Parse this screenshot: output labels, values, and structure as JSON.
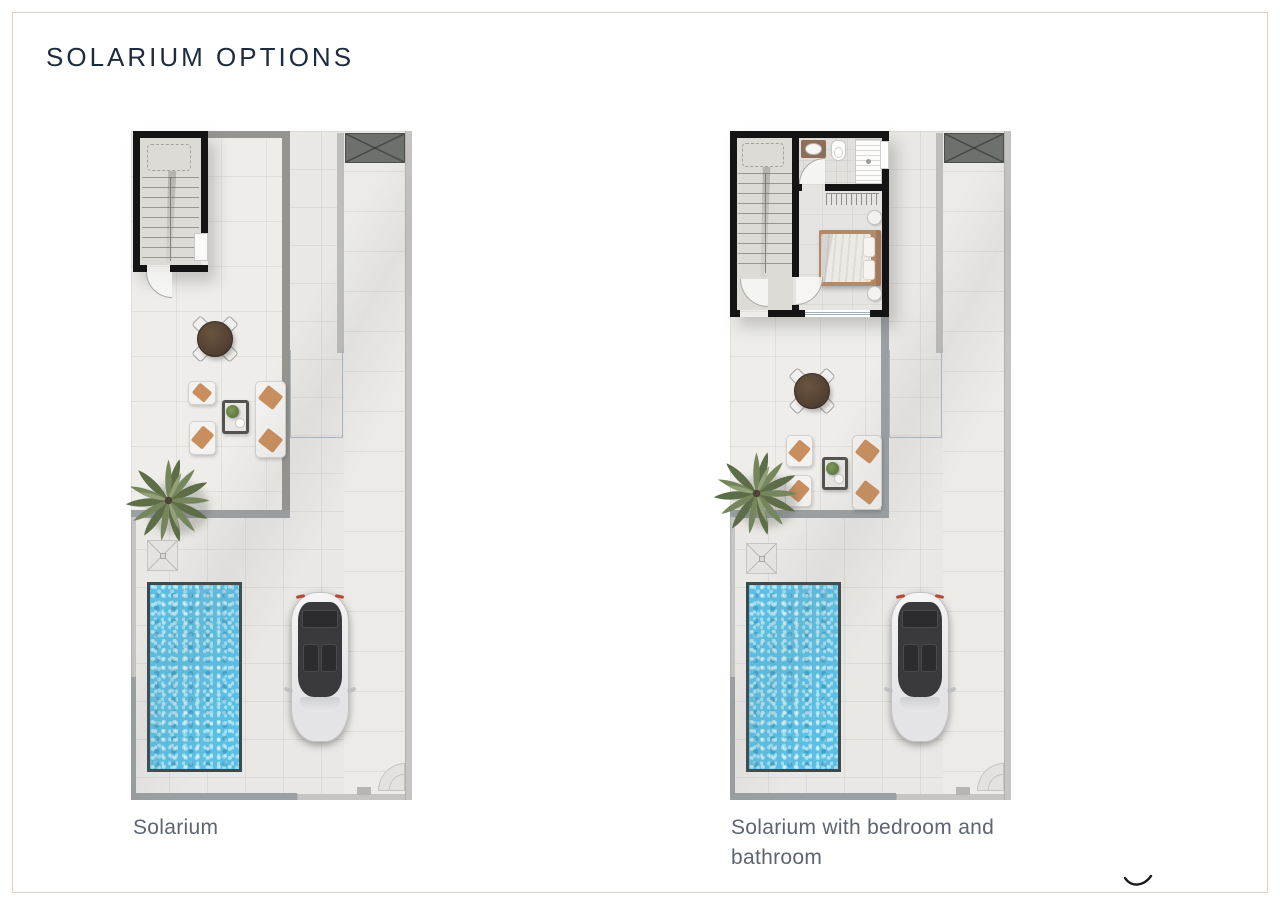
{
  "page": {
    "title": "SOLARIUM OPTIONS"
  },
  "plans": [
    {
      "caption": "Solarium",
      "features": [
        "staircase",
        "void-skylight",
        "dining-table",
        "lounge-armchairs",
        "sofa",
        "coffee-table-with-plant",
        "palm-tree",
        "outdoor-shower",
        "swimming-pool",
        "parked-car"
      ]
    },
    {
      "caption": "Solarium with bedroom and bathroom",
      "features": [
        "staircase",
        "void-skylight",
        "bathroom-vanity-sink",
        "toilet",
        "shower",
        "wardrobe",
        "double-bed",
        "nightstands",
        "dining-table",
        "lounge-armchairs",
        "sofa",
        "coffee-table-with-plant",
        "palm-tree",
        "outdoor-shower",
        "swimming-pool",
        "parked-car"
      ]
    }
  ],
  "colors": {
    "title_text": "#1c2b3d",
    "caption_text": "#5c6571",
    "page_border": "#dccfbe",
    "wall_black": "#141414",
    "wall_gray": "#95948f",
    "wall_light": "#c6c5c3",
    "floor_tile": "#e9e8e5",
    "pool_water": "#5bbfe3",
    "pool_edge": "#3a4a50",
    "void_marker_fill": "#6e716b",
    "wood_table": "#5a4636",
    "palm_foliage": "#75865c",
    "cushion_tan": "#c98e5e"
  }
}
